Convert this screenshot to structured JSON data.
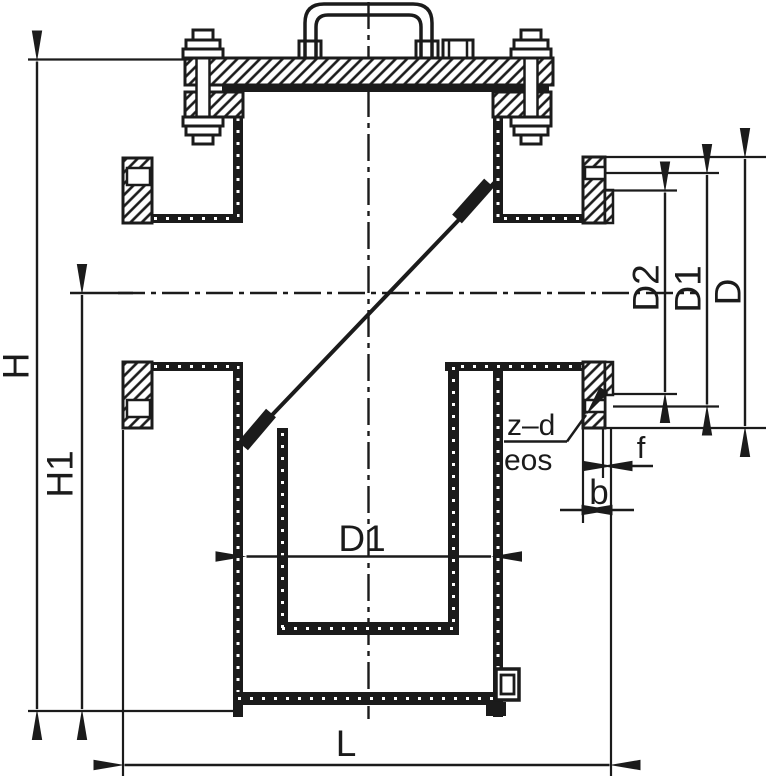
{
  "colors": {
    "ink": "#1b1b1b",
    "paper": "#ffffff"
  },
  "dimension_labels": {
    "overall_height": "H",
    "centerline_to_base_height": "H1",
    "flange_face_diameter": "D2",
    "bolt_circle_diameter": "D1",
    "flange_outside_diameter": "D",
    "body_bore_diameter": "D1",
    "face_to_face_length": "L",
    "raised_face_height": "f",
    "flange_thickness": "b"
  },
  "callouts": {
    "bolt_holes": "z–d",
    "bolt_holes_sub": "eos"
  }
}
